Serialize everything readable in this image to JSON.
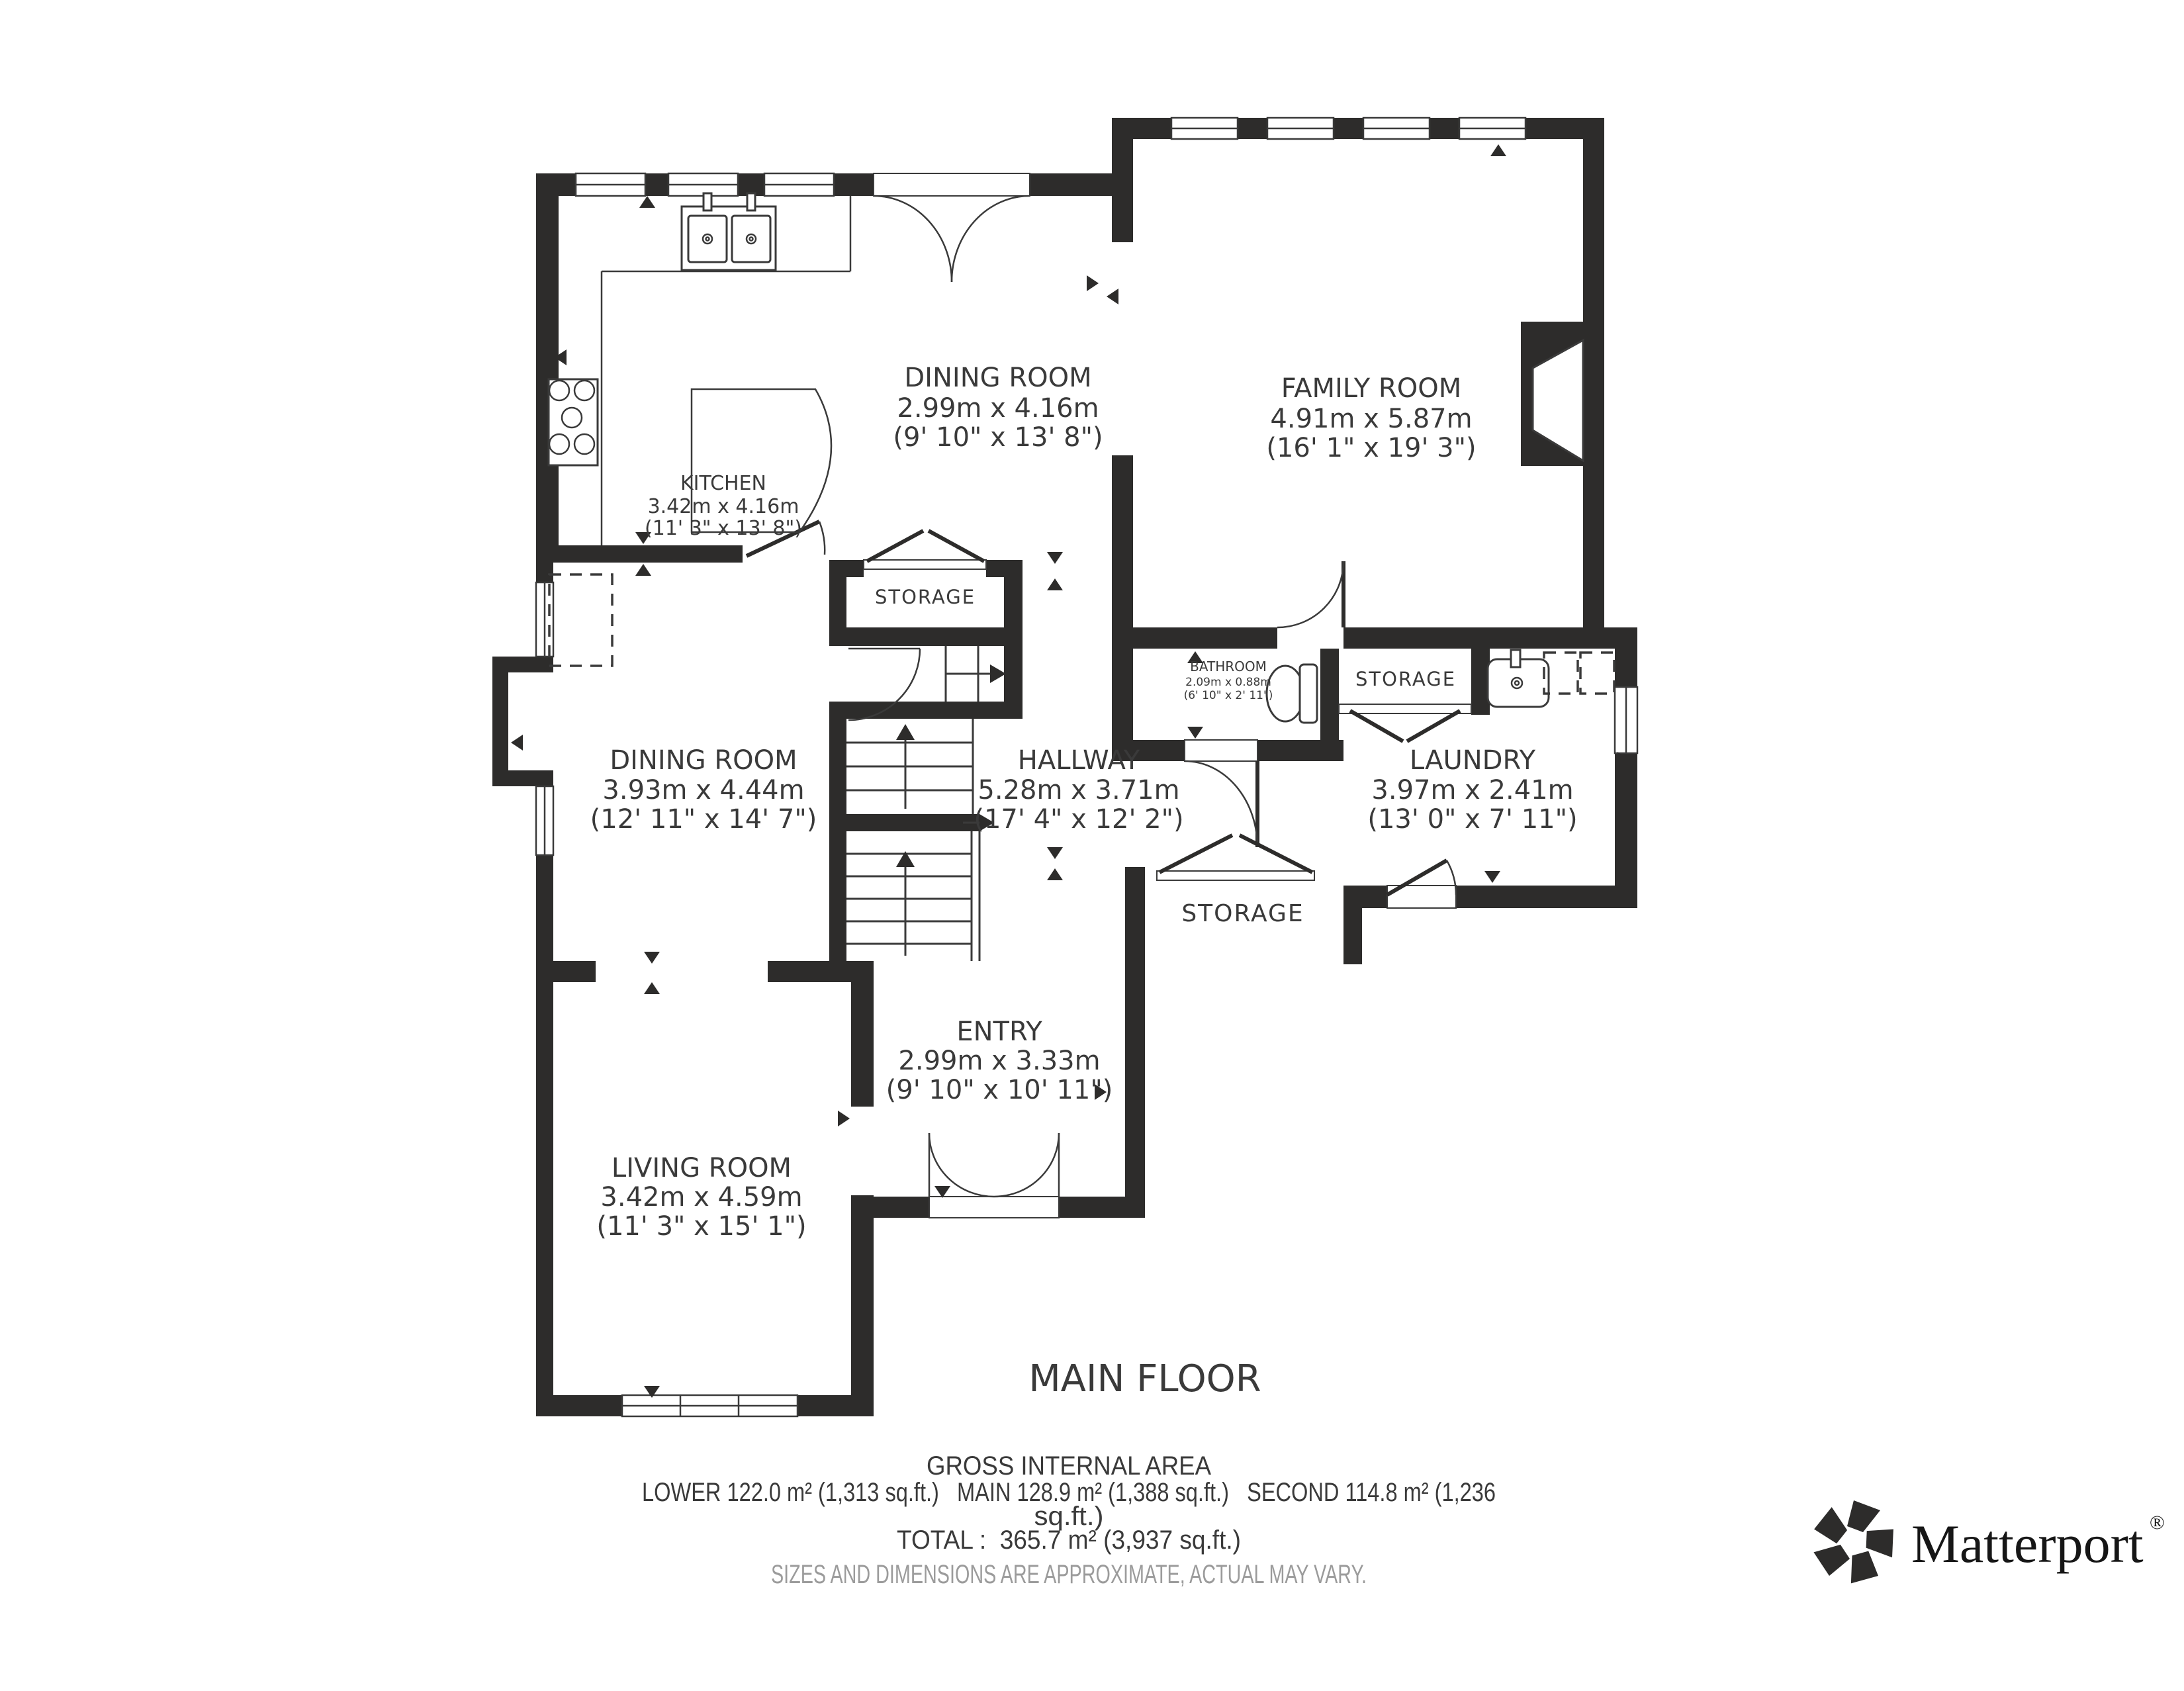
{
  "page": {
    "title": "MAIN FLOOR"
  },
  "rooms": [
    {
      "name": "DINING ROOM",
      "metric": "2.99m x 4.16m",
      "imperial": "(9' 10\" x 13' 8\")"
    },
    {
      "name": "FAMILY ROOM",
      "metric": "4.91m x 5.87m",
      "imperial": "(16' 1\" x 19' 3\")"
    },
    {
      "name": "KITCHEN",
      "metric": "3.42m x 4.16m",
      "imperial": "(11' 3\" x 13' 8\")"
    },
    {
      "name": "DINING ROOM",
      "metric": "3.93m x 4.44m",
      "imperial": "(12' 11\" x 14' 7\")"
    },
    {
      "name": "HALLWAY",
      "metric": "5.28m x 3.71m",
      "imperial": "(17' 4\" x 12' 2\")"
    },
    {
      "name": "BATHROOM",
      "metric": "2.09m x 0.88m",
      "imperial": "(6' 10\" x 2' 11\")"
    },
    {
      "name": "LAUNDRY",
      "metric": "3.97m x 2.41m",
      "imperial": "(13' 0\" x 7' 11\")"
    },
    {
      "name": "ENTRY",
      "metric": "2.99m x 3.33m",
      "imperial": "(9' 10\" x 10' 11\")"
    },
    {
      "name": "LIVING ROOM",
      "metric": "3.42m x 4.59m",
      "imperial": "(11' 3\" x 15' 1\")"
    }
  ],
  "closets": [
    {
      "label": "STORAGE"
    },
    {
      "label": "STORAGE"
    },
    {
      "label": "STORAGE"
    }
  ],
  "footer": {
    "heading": "GROSS INTERNAL AREA",
    "areas_line1": "LOWER 122.0 m² (1,313 sq.ft.)   MAIN 128.9 m² (1,388 sq.ft.)   SECOND 114.8 m² (1,236",
    "areas_line2": "sq.ft.)",
    "total": "TOTAL :  365.7 m² (3,937 sq.ft.)",
    "disclaimer": "SIZES AND DIMENSIONS ARE APPROXIMATE, ACTUAL MAY VARY."
  },
  "brand": {
    "name": "Matterport",
    "registered": "®"
  },
  "colors": {
    "wall": "#2d2c2b",
    "text": "#3a3a3a",
    "muted": "#9b9b9b"
  }
}
